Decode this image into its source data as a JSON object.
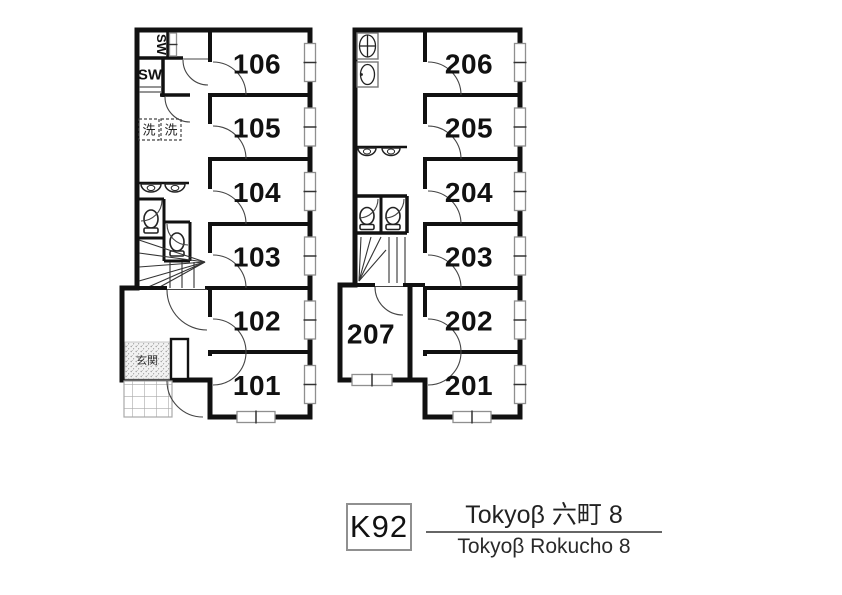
{
  "floor1": {
    "rooms": [
      {
        "number": "106"
      },
      {
        "number": "105"
      },
      {
        "number": "104"
      },
      {
        "number": "103"
      },
      {
        "number": "102"
      },
      {
        "number": "101"
      }
    ],
    "closet_label_vertical": "SW",
    "closet_label": "SW",
    "laundry_labels": [
      "洗",
      "洗"
    ],
    "entrance_label": "玄関"
  },
  "floor2": {
    "rooms": [
      {
        "number": "206"
      },
      {
        "number": "205"
      },
      {
        "number": "204"
      },
      {
        "number": "203"
      },
      {
        "number": "202"
      },
      {
        "number": "201"
      },
      {
        "number": "207"
      }
    ]
  },
  "legend": {
    "plan_code": "K92",
    "title_jp": "Tokyoβ 六町 8",
    "title_en": "Tokyoβ Rokucho 8"
  },
  "colors": {
    "wall": "#111111",
    "window_stroke": "#8f8f8f",
    "legend_box_border": "#909090",
    "text": "#111111"
  }
}
